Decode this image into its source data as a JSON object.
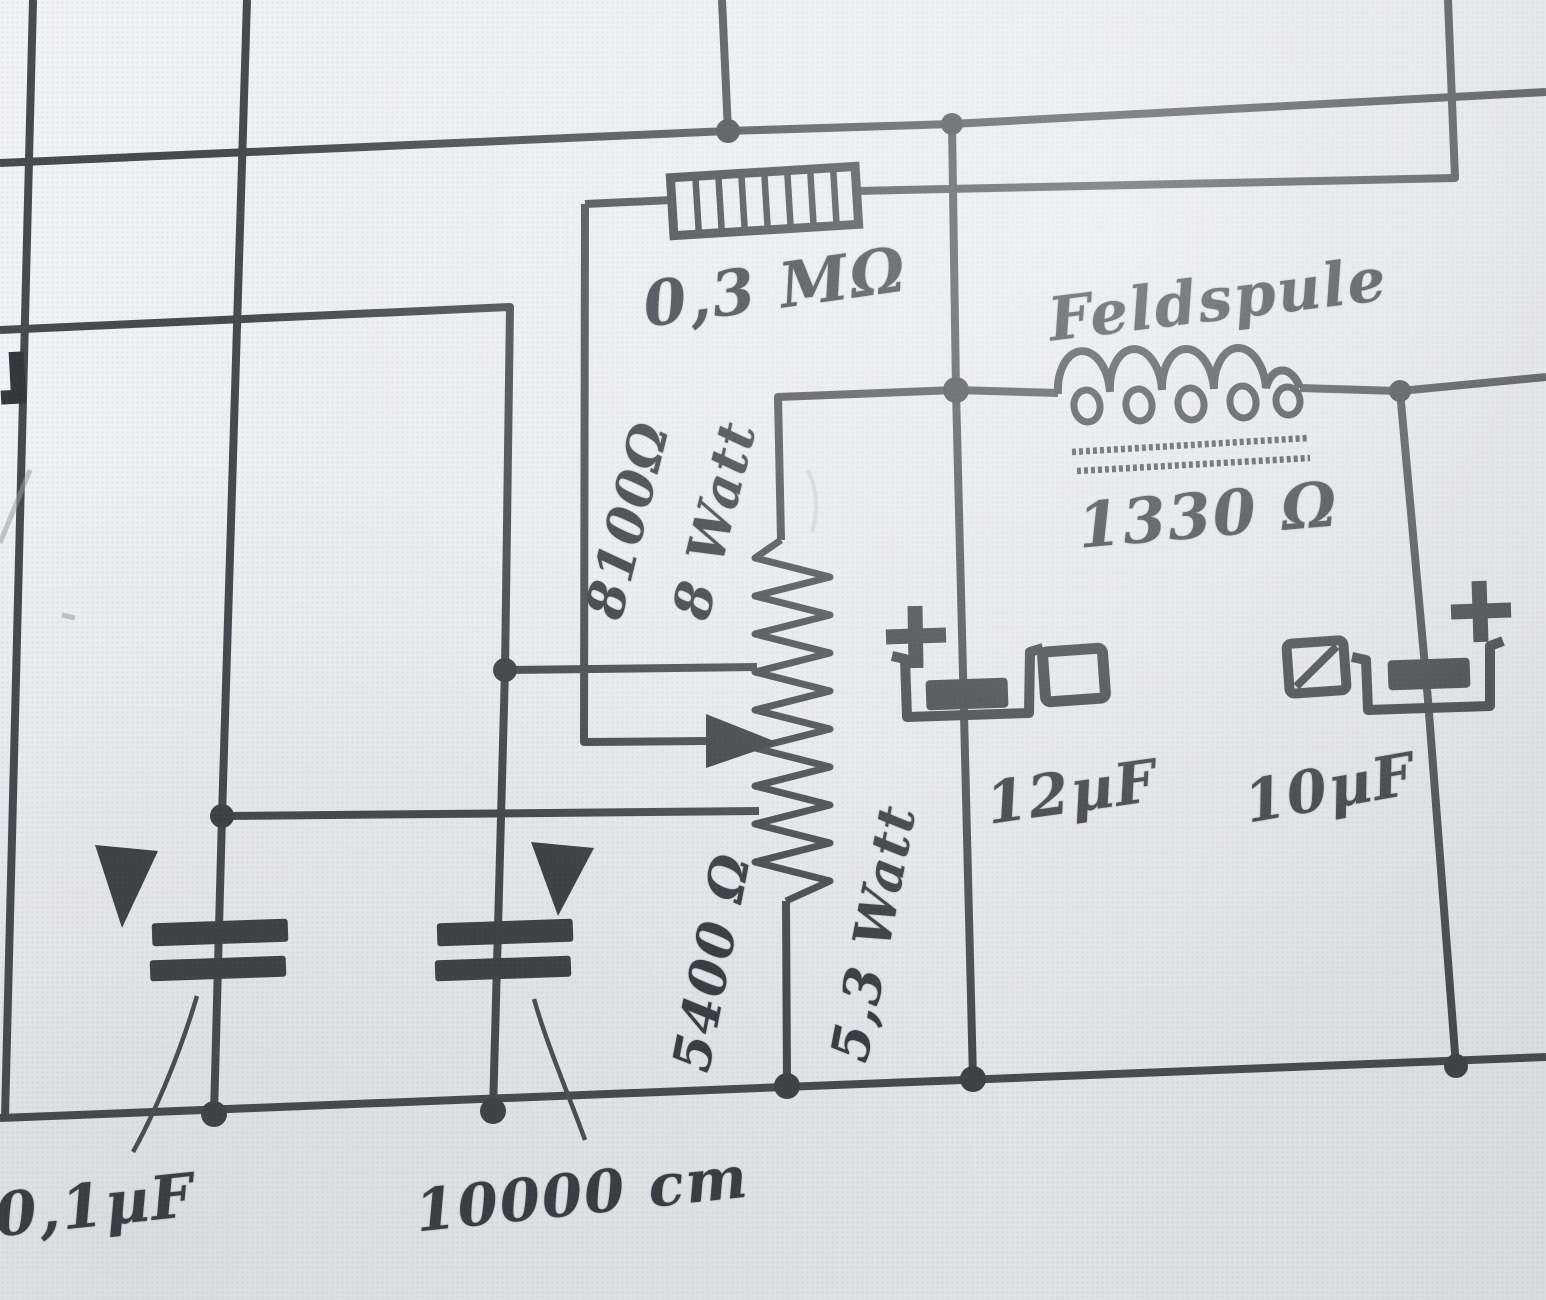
{
  "schematic": {
    "components": {
      "resistor_top": {
        "label": "0,3 MΩ"
      },
      "divider_upper": {
        "value": "8100Ω",
        "power": "8 Watt"
      },
      "divider_lower": {
        "value": "5400 Ω",
        "power": "5,3 Watt"
      },
      "field_coil": {
        "name": "Feldspule",
        "value": "1330 Ω"
      },
      "cap_12uf": {
        "label": "12µF"
      },
      "cap_10uf": {
        "label": "10µF"
      },
      "cap_01uf": {
        "label": "0,1µF"
      },
      "cap_10000cm": {
        "label": "10000 cm"
      }
    },
    "icons": {
      "plus": "+",
      "wiper_arrow": "right-pointing solid triangle",
      "polarity_arrow": "down-pointing solid triangle",
      "terminal_square": "small open square",
      "terminal_square_slashed": "small open square with diagonal stroke"
    },
    "colors": {
      "ink": "#3e4147",
      "paper": "#e7e9ed"
    }
  }
}
